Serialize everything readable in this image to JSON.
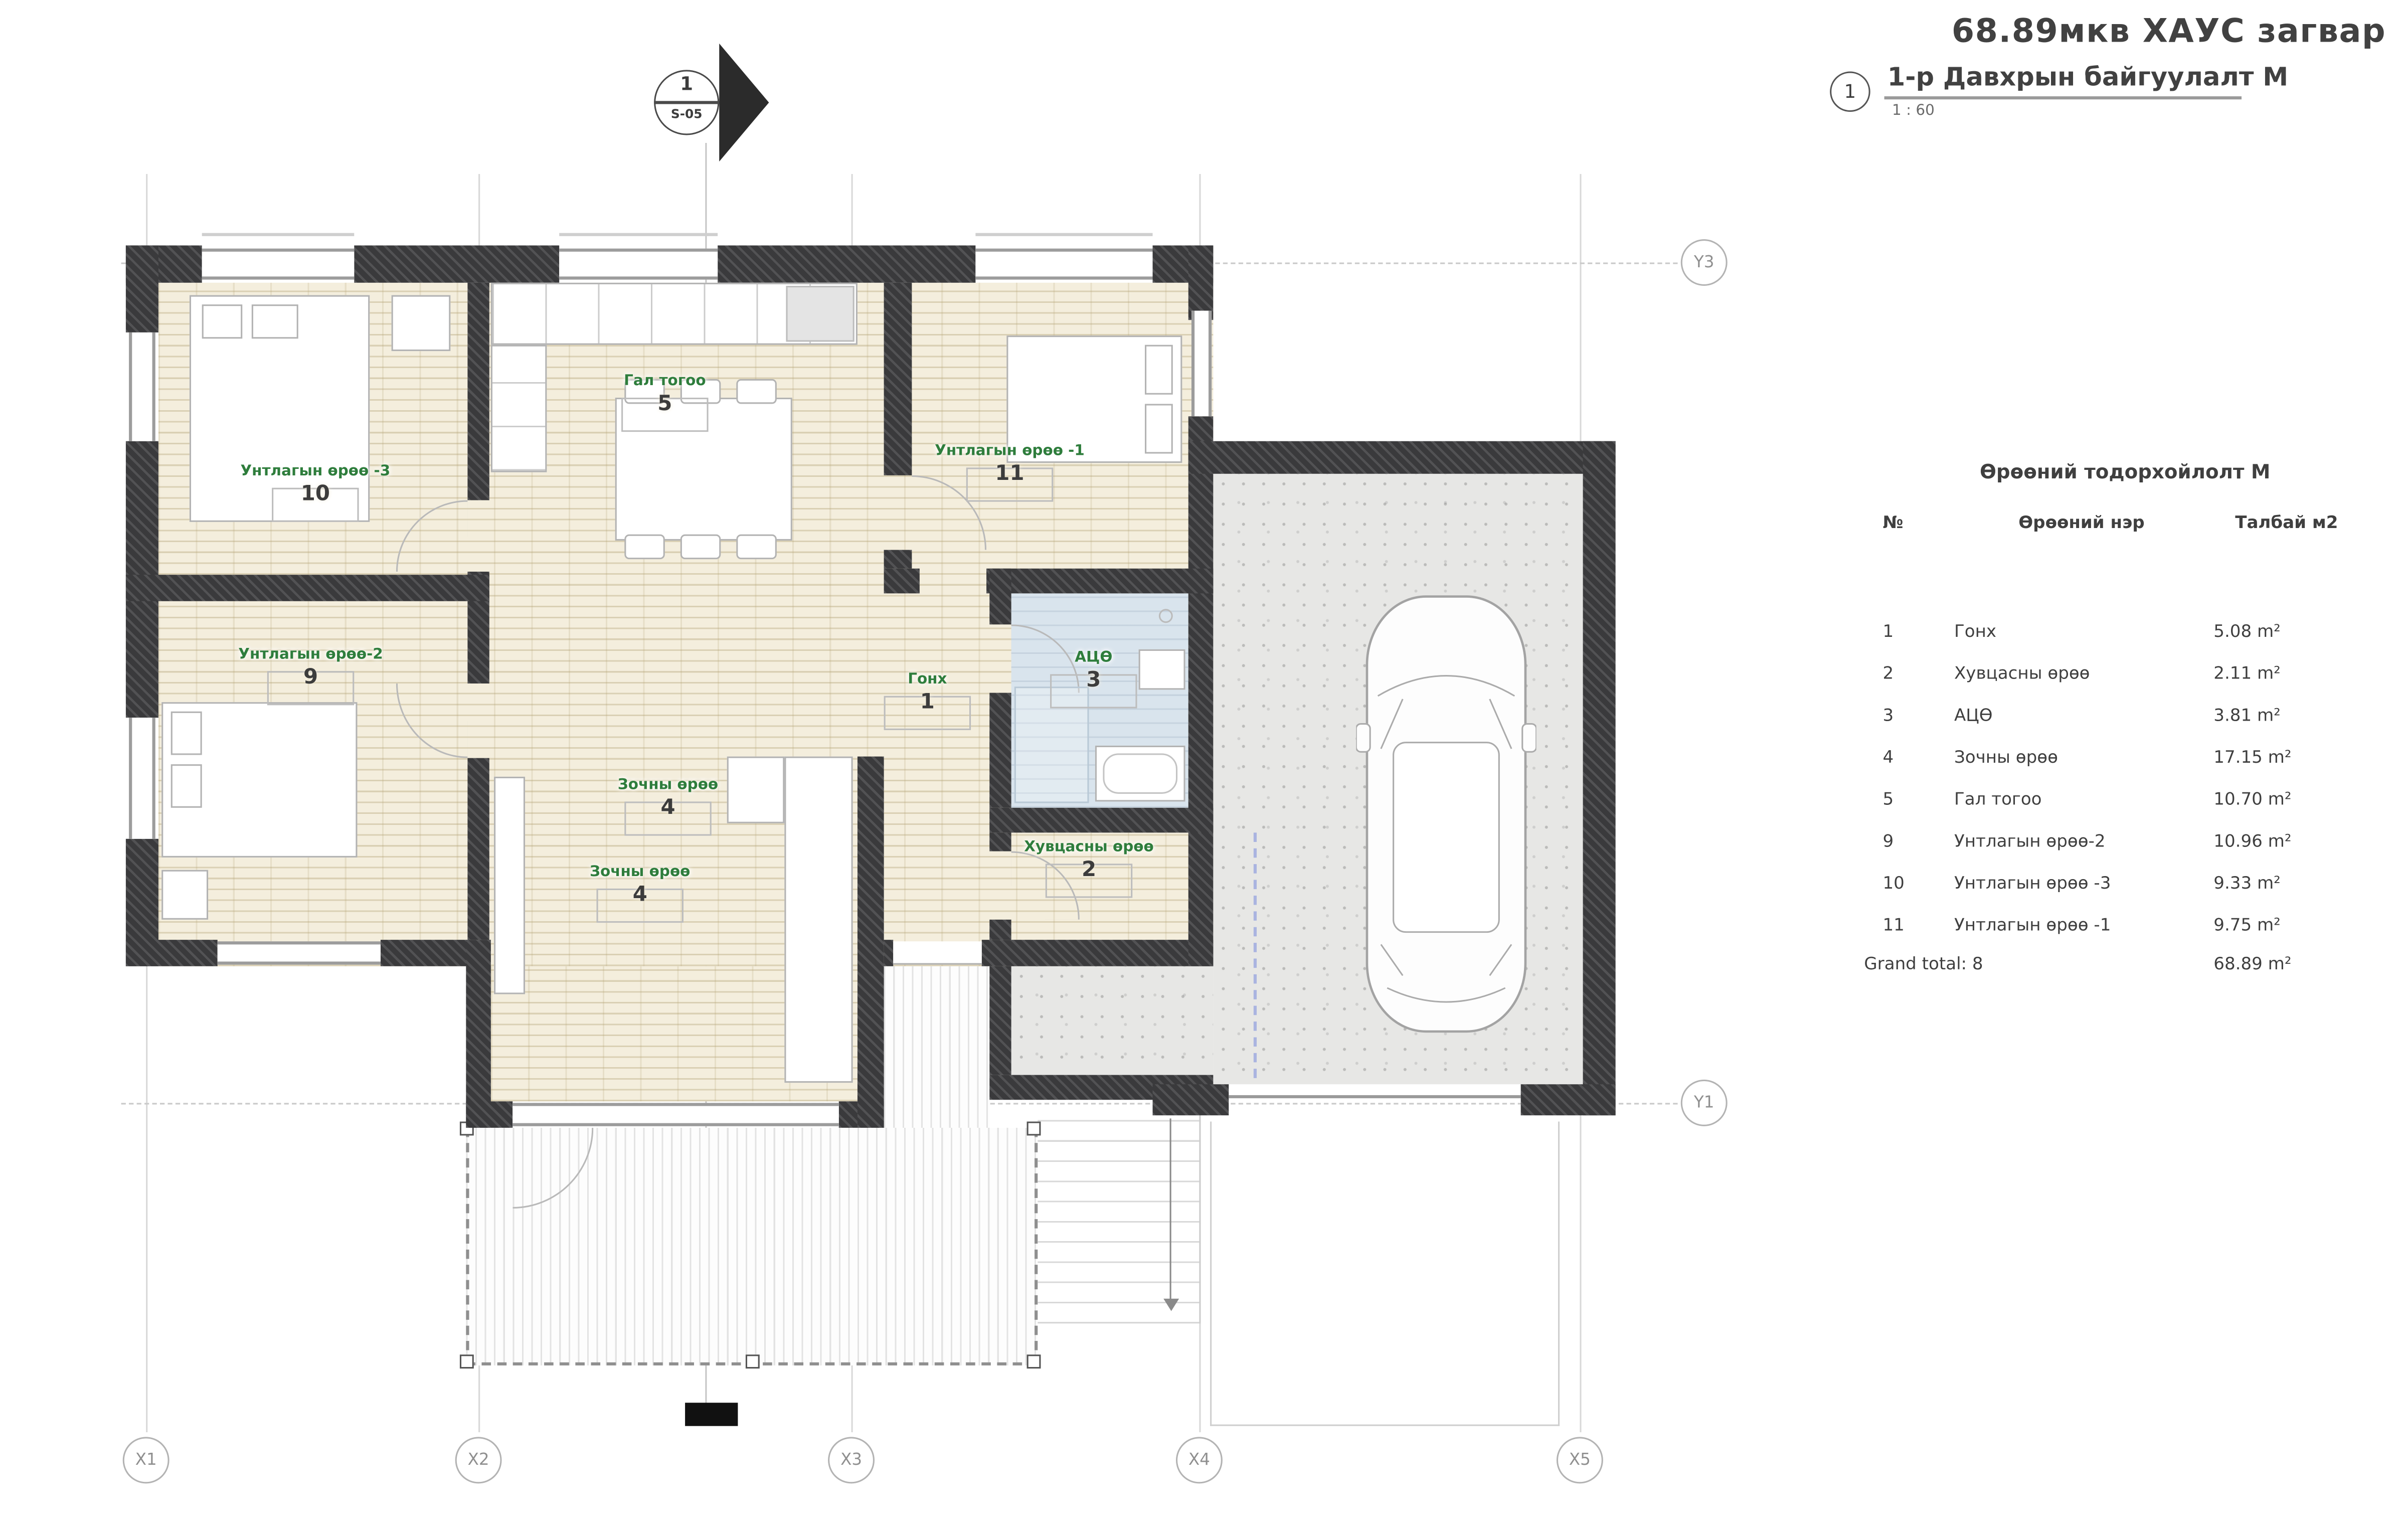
{
  "title": "68.89мкв ХАУС загвар",
  "view": {
    "number": "1",
    "name": "1-р Давхрын байгуулалт М",
    "scale": "1 : 60"
  },
  "section_marker": {
    "number": "1",
    "sheet": "S-05"
  },
  "legend": {
    "title": "Өрөөний тодорхойлолт М",
    "columns": {
      "no": "№",
      "name": "Өрөөний нэр",
      "area": "Талбай м2"
    },
    "rows": [
      {
        "no": "1",
        "name": "Гонх",
        "area": "5.08 m²"
      },
      {
        "no": "2",
        "name": "Хувцасны өрөө",
        "area": "2.11 m²"
      },
      {
        "no": "3",
        "name": "АЦӨ",
        "area": "3.81 m²"
      },
      {
        "no": "4",
        "name": "Зочны өрөө",
        "area": "17.15 m²"
      },
      {
        "no": "5",
        "name": "Гал тогоо",
        "area": "10.70 m²"
      },
      {
        "no": "9",
        "name": "Унтлагын өрөө-2",
        "area": "10.96 m²"
      },
      {
        "no": "10",
        "name": "Унтлагын өрөө -3",
        "area": "9.33 m²"
      },
      {
        "no": "11",
        "name": "Унтлагын өрөө -1",
        "area": "9.75 m²"
      }
    ],
    "total_label": "Grand total: 8",
    "total_area": "68.89 m²"
  },
  "rooms": [
    {
      "name": "Гал тогоо",
      "no": "5"
    },
    {
      "name": "Унтлагын өрөө -3",
      "no": "10"
    },
    {
      "name": "Унтлагын өрөө -1",
      "no": "11"
    },
    {
      "name": "Унтлагын өрөө-2",
      "no": "9"
    },
    {
      "name": "Гонх",
      "no": "1"
    },
    {
      "name": "АЦӨ",
      "no": "3"
    },
    {
      "name": "Зочны өрөө",
      "no": "4"
    },
    {
      "name": "Зочны өрөө",
      "no": "4"
    },
    {
      "name": "Хувцасны өрөө",
      "no": "2"
    }
  ],
  "grid": {
    "x": [
      "X1",
      "X2",
      "X3",
      "X4",
      "X5"
    ],
    "y": [
      "Y3",
      "Y1"
    ]
  },
  "stairs_label": "DN",
  "colors": {
    "wall": "#3a3a3c",
    "wood": "#f4eedd",
    "bath": "#d9e4ed",
    "concrete": "#e7e7e5",
    "label_green": "#2e7d3c",
    "text": "#3f3f3f"
  }
}
